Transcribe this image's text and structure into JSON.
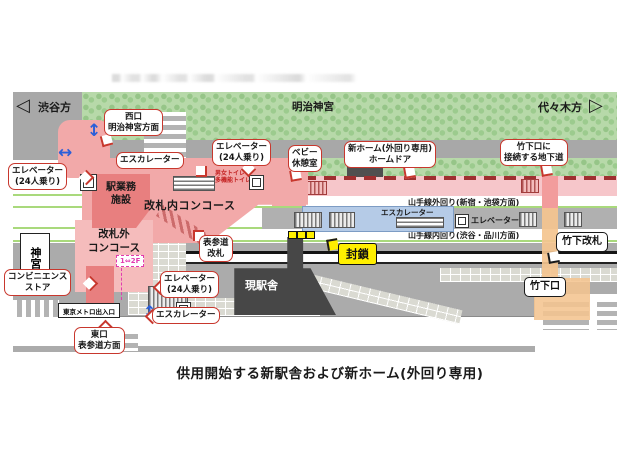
{
  "caption": "供用開始する新駅舎および新ホーム(外回り専用)",
  "compass": {
    "left_label": "渋谷方",
    "right_label": "代々木方",
    "left_arrow_glyph": "◁",
    "right_arrow_glyph": "▷"
  },
  "icons": {
    "updown_arrow_glyph": "↕",
    "leftright_arrow_glyph": "↔"
  },
  "areas": {
    "forest": "明治神宮",
    "station_office_l1": "駅業務",
    "station_office_l2": "施設",
    "concourse_inside": "改札内コンコース",
    "concourse_outside_l1": "改札外",
    "concourse_outside_l2": "コンコース",
    "current_station": "現駅舎",
    "jingu_bridge": "神宮橋",
    "metro_entrance": "東京メトロ出入口",
    "sealed": "封鎖",
    "floor_link": "1⇔2F",
    "toilet_l1": "男女トイレ",
    "toilet_l2": "多機能トイレ"
  },
  "tracks": {
    "outer": "山手線外回り(新宿・池袋方面)",
    "inner": "山手線内回り(渋谷・品川方面)"
  },
  "platform_labels": {
    "escalator": "エスカレーター",
    "elevator": "エレベーター"
  },
  "callouts": {
    "west_exit": {
      "l1": "西口",
      "l2": "明治神宮方面"
    },
    "elevator_west": {
      "l1": "エレベーター",
      "l2": "(24人乗り)"
    },
    "escalator_west": {
      "l1": "エスカレーター"
    },
    "elevator_center": {
      "l1": "エレベーター",
      "l2": "(24人乗り)"
    },
    "baby_room": {
      "l1": "ベビー",
      "l2": "休憩室"
    },
    "new_platform": {
      "l1": "新ホーム(外回り専用)",
      "l2": "ホームドア"
    },
    "takeshita_passage": {
      "l1": "竹下口に",
      "l2": "接続する地下道"
    },
    "omotesando_gate": {
      "l1": "表参道",
      "l2": "改札"
    },
    "elevator_east": {
      "l1": "エレベーター",
      "l2": "(24人乗り)"
    },
    "escalator_east": {
      "l1": "エスカレーター"
    },
    "convenience_store": {
      "l1": "コンビニエンス",
      "l2": "ストア"
    },
    "east_exit": {
      "l1": "東口",
      "l2": "表参道方面"
    },
    "takeshita_gate": "竹下改札",
    "takeshita_exit": "竹下口"
  },
  "colors": {
    "forest_green": "#b7d9a9",
    "road_gray": "#a8a8a8",
    "new_platform_pink": "#f6c6ca",
    "concourse_pink": "#f2a9a9",
    "office_red": "#e87f7f",
    "platform_blue": "#b5cbe7",
    "current_station_gray": "#474747",
    "passage_orange": "#f4c48f",
    "sealed_yellow": "#ffef00",
    "callout_border_red": "#c8372d",
    "track_line_green": "#a9d97c"
  }
}
